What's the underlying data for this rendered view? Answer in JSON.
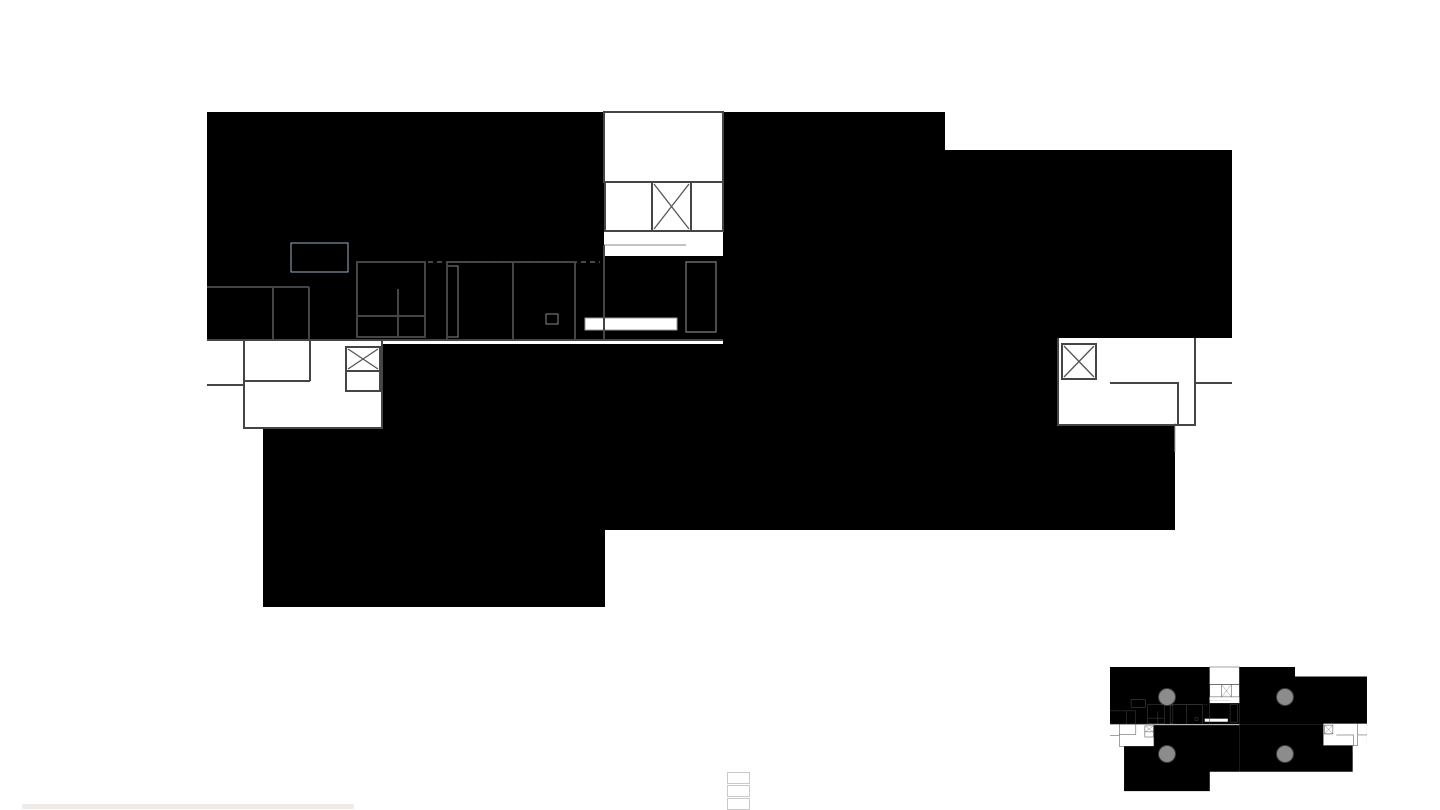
{
  "title": "Grundriss 1. Obergeschoss, Variante 02",
  "legend": {
    "title": "Legende Mietflächen",
    "items": [
      {
        "label": "1) Fläche best",
        "color": "#cddcec"
      },
      {
        "label": "2) Fläche neu - 536m2",
        "color": "#fae2c1"
      }
    ],
    "partial_third_swatch_color": "#f7e5d3"
  },
  "minimap": {
    "labels": [
      "1",
      "2",
      "3",
      "4"
    ]
  },
  "colors": {
    "zone1": "#cddcec",
    "zone2": "#fae2c1",
    "zone3": "#dcc5c9",
    "zone4": "#cfc9da",
    "red": "#e30613",
    "wall": "#454545",
    "furniture": "#7e96ba"
  }
}
